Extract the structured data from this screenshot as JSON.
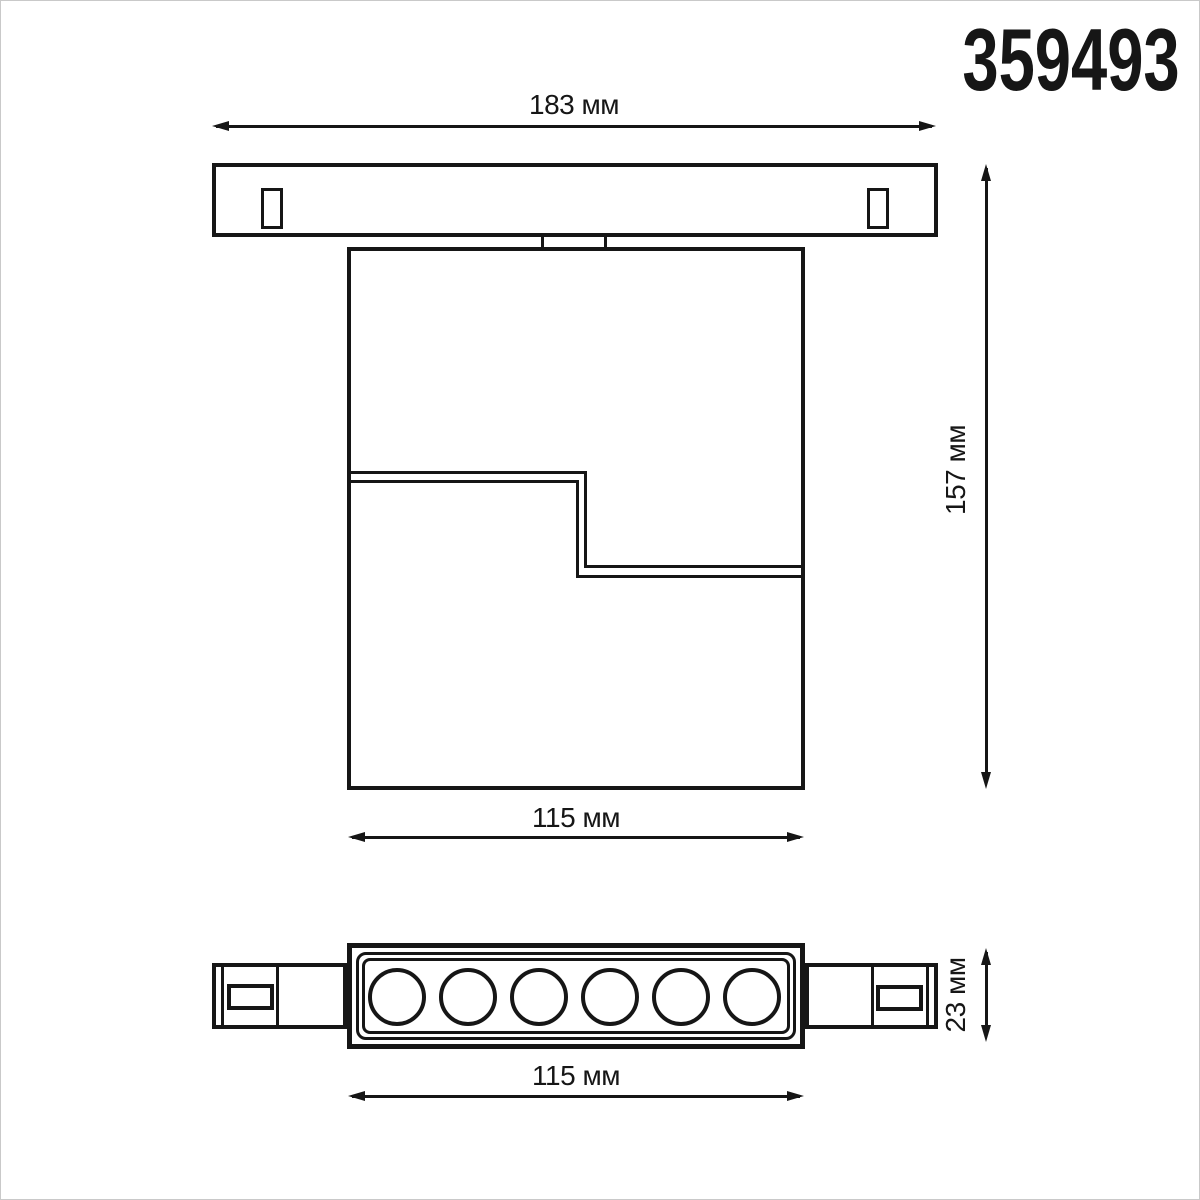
{
  "part_number": "359493",
  "dimensions": {
    "track_length": "183 мм",
    "overall_height": "157 мм",
    "body_width": "115 мм",
    "head_width": "115 мм",
    "head_height": "23 мм"
  },
  "bottom_view": {
    "led_count": 6
  },
  "colors": {
    "line": "#161616",
    "background": "#ffffff"
  }
}
